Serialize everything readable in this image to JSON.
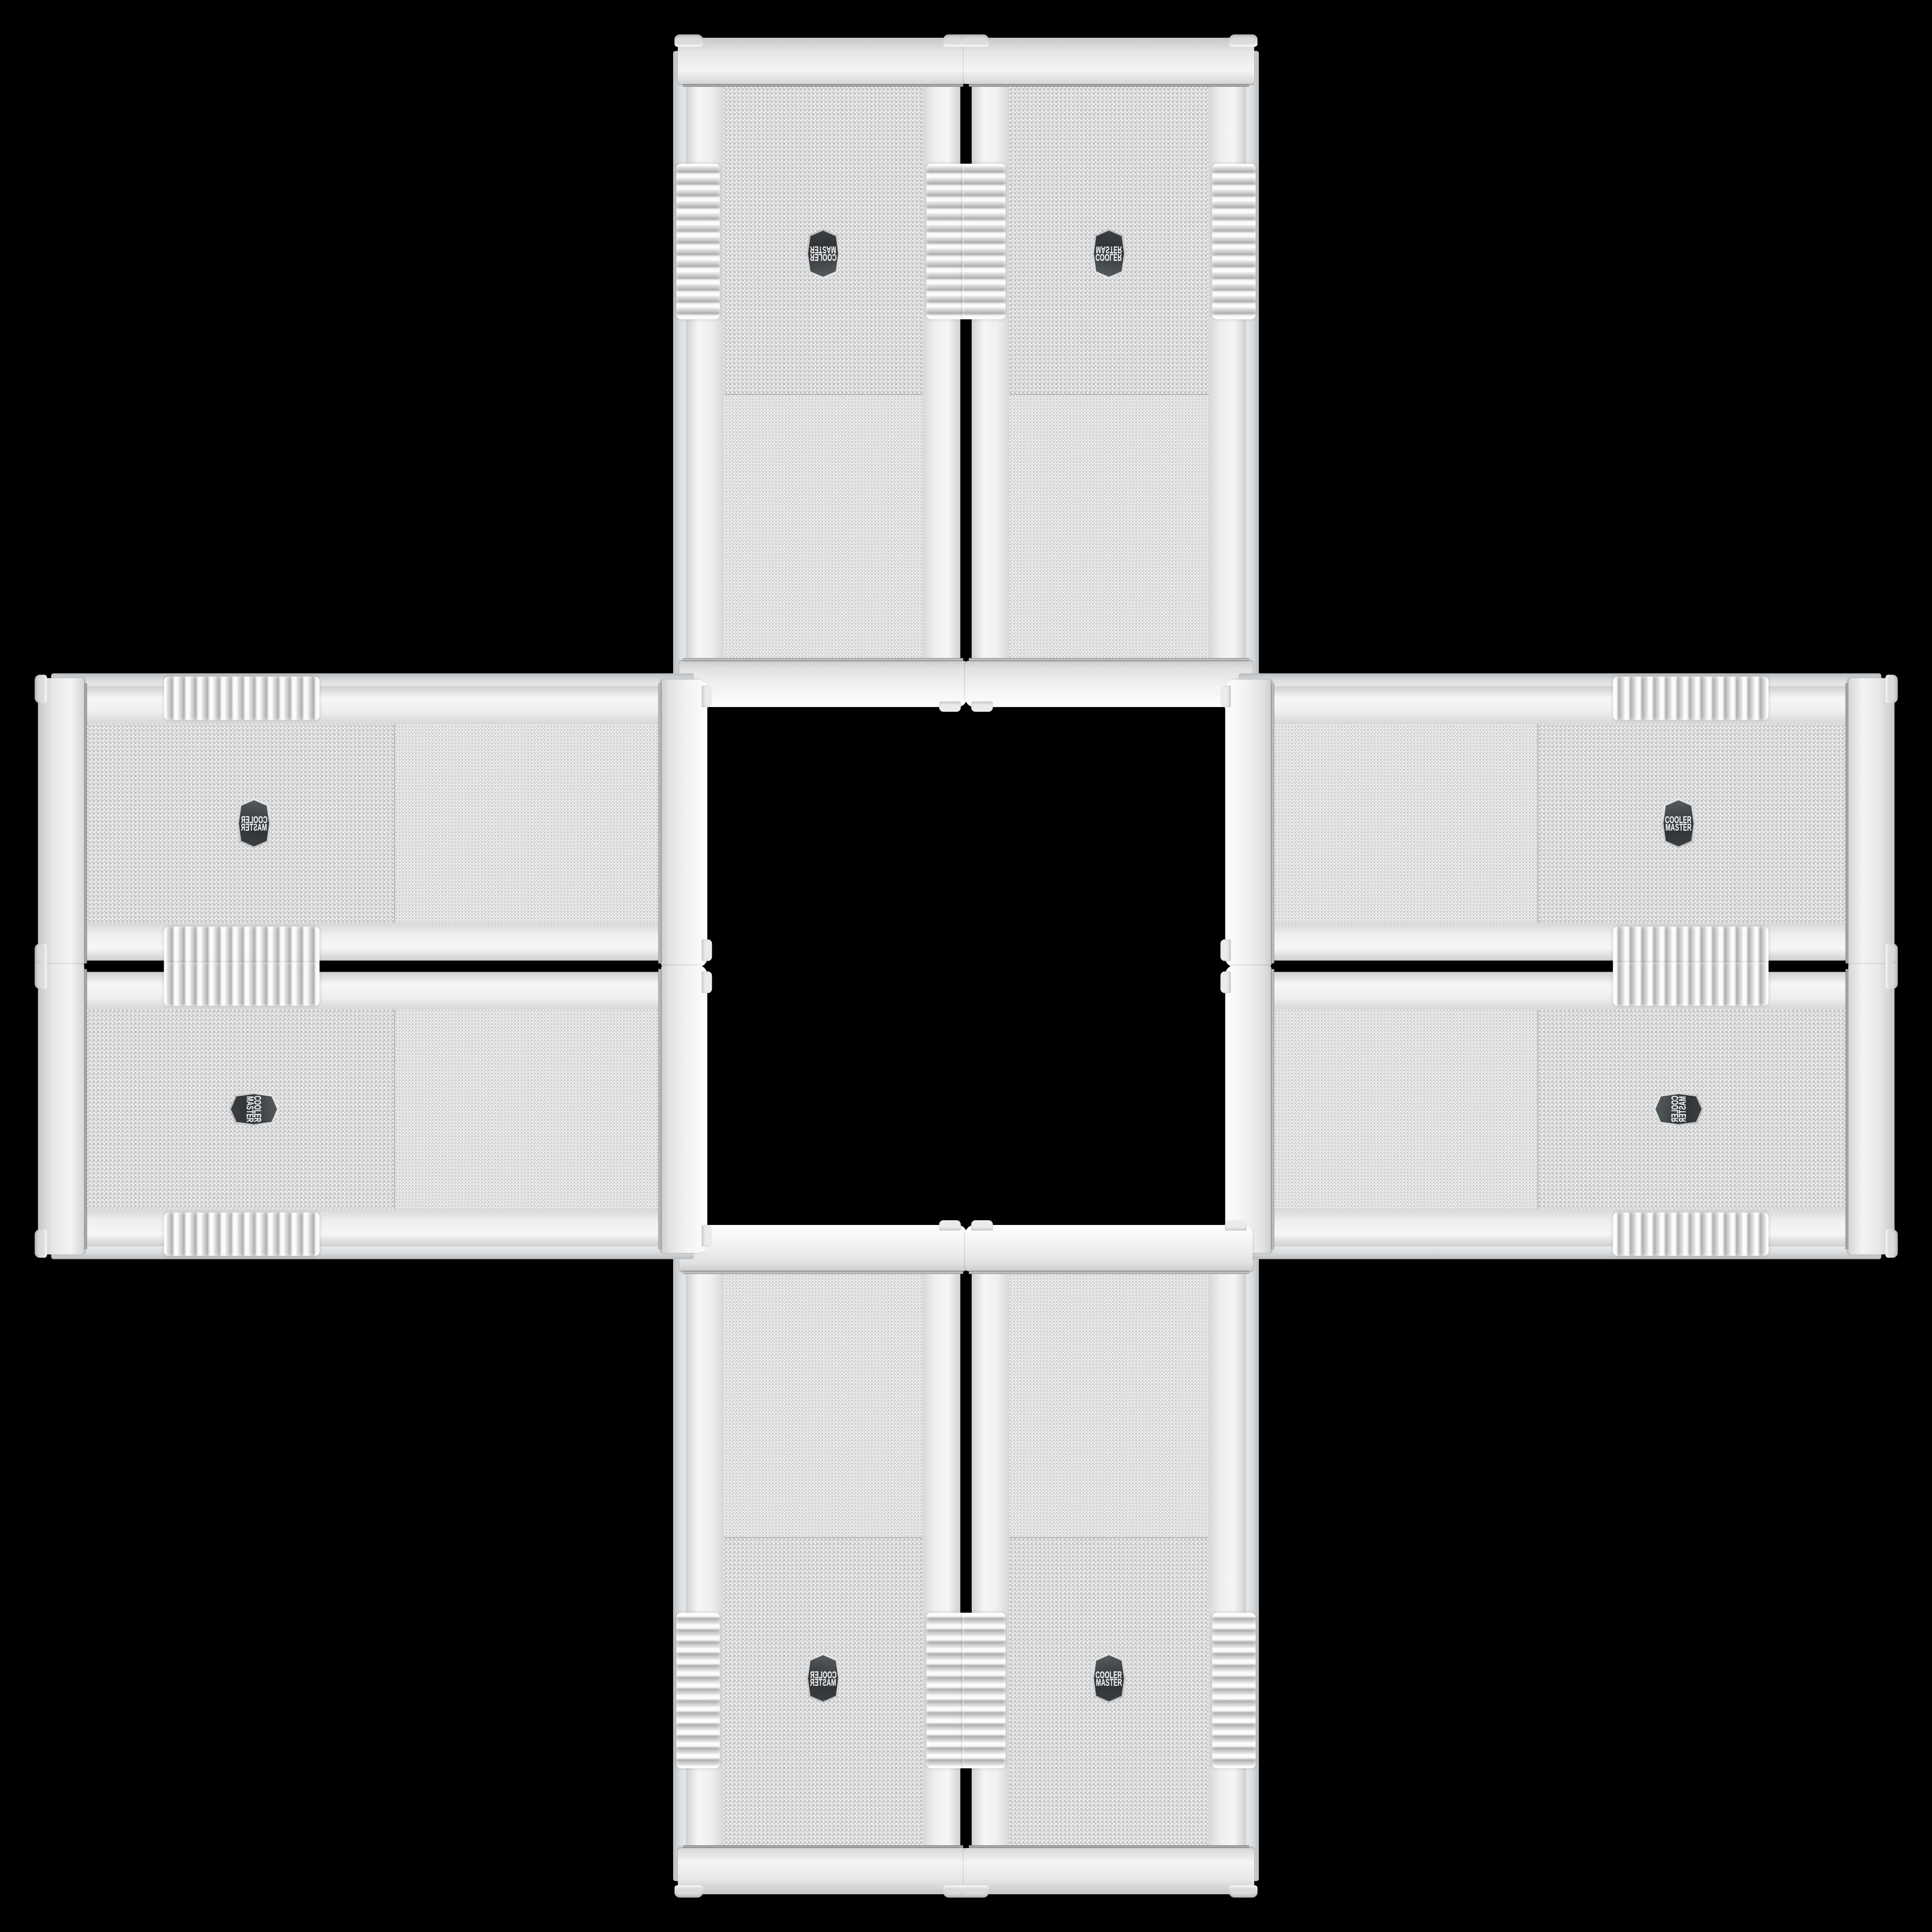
{
  "page": {
    "background_color": "#000000",
    "description": "Eight white Cooler Master PC case front panels arranged in a plus/cross pattern on black"
  },
  "brand_badge": {
    "line1": "COOLER",
    "line2": "MASTER",
    "badge_background": "#36393c",
    "badge_ring": "#c9cdd0",
    "text_color": "#f4f5f6"
  },
  "palette": {
    "case_white": "#f2f2f2",
    "panel_shadow": "#cfcfcf",
    "mesh_base": "#f1f1f1",
    "mesh_dot": "#c8c8c8",
    "chrome_trim": "#a9adb0",
    "rib_shadow": "#aeaeae"
  },
  "cases": [
    {
      "id": "tower-top-left",
      "orientation": "vertical, upside down",
      "transform": "rot180",
      "badge_counter_rotated": false,
      "badge_text_appearance": "rotated 180"
    },
    {
      "id": "tower-top-right",
      "orientation": "vertical, flipped vertically",
      "transform": "flip-v",
      "badge_counter_rotated": false,
      "badge_text_appearance": "flipped vertically"
    },
    {
      "id": "tower-bottom-left",
      "orientation": "vertical, mirrored",
      "transform": "flip-h",
      "badge_counter_rotated": false,
      "badge_text_appearance": "mirrored"
    },
    {
      "id": "tower-bottom-right",
      "orientation": "vertical, upright",
      "transform": "none",
      "badge_counter_rotated": false,
      "badge_text_appearance": "readable"
    },
    {
      "id": "side-left-top",
      "orientation": "horizontal, mesh end toward center",
      "transform": "rot90ccw-mirror",
      "badge_counter_rotated": true,
      "badge_text_appearance": "mirrored horizontal"
    },
    {
      "id": "side-left-bottom",
      "orientation": "horizontal, mesh end outward",
      "transform": "rot90cw",
      "badge_counter_rotated": false,
      "badge_text_appearance": "rotated 90 cw"
    },
    {
      "id": "side-right-top",
      "orientation": "horizontal, mesh end outward",
      "transform": "rot90ccw",
      "badge_counter_rotated": true,
      "badge_text_appearance": "readable horizontal"
    },
    {
      "id": "side-right-bottom",
      "orientation": "horizontal, mesh end toward center",
      "transform": "rot90cw-mirror",
      "badge_counter_rotated": false,
      "badge_text_appearance": "rotated 90 mirrored"
    }
  ]
}
